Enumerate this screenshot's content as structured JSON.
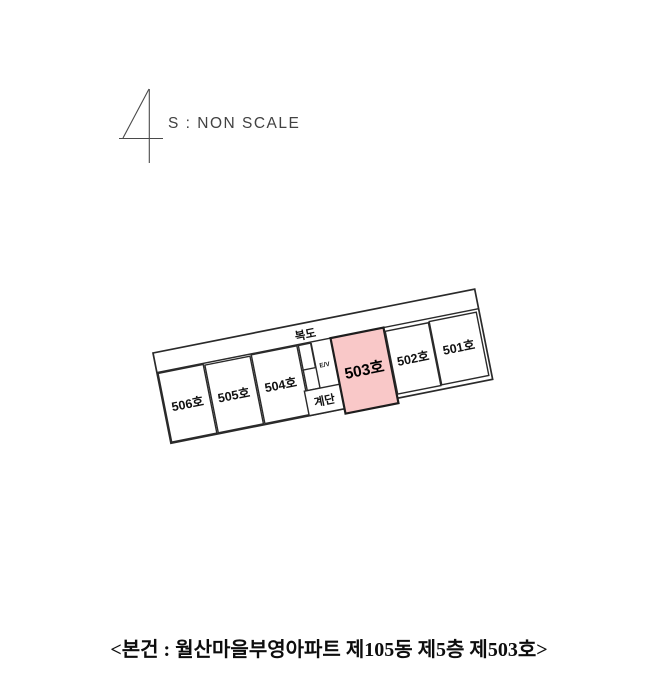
{
  "scale_header": {
    "figure_number": "4",
    "scale_note": "S : NON SCALE"
  },
  "floor_plan": {
    "corridor_label": "복도",
    "elevator_label": "E/V",
    "stairs_label": "계단",
    "units": [
      {
        "label": "506호",
        "highlighted": false
      },
      {
        "label": "505호",
        "highlighted": false
      },
      {
        "label": "504호",
        "highlighted": false
      },
      {
        "label": "503호",
        "highlighted": true
      },
      {
        "label": "502호",
        "highlighted": false
      },
      {
        "label": "501호",
        "highlighted": false
      }
    ],
    "highlight_color": "#f9c8c8",
    "line_color": "#2a2a2a"
  },
  "caption": {
    "text": "<본건 : 월산마을부영아파트 제105동 제5층 제503호>"
  }
}
